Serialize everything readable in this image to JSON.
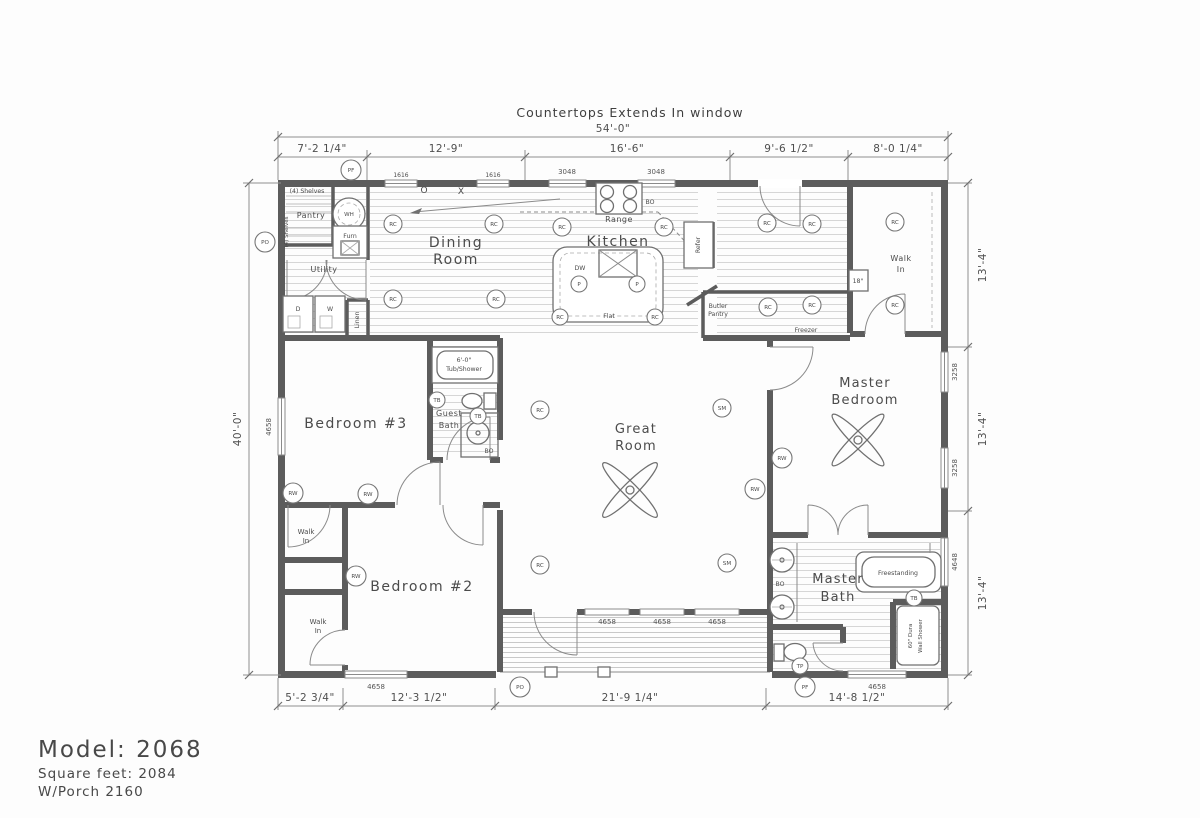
{
  "title": "Countertops Extends In window",
  "footer": {
    "model": "Model: 2068",
    "sqft": "Square feet: 2084",
    "porch": "W/Porch 2160"
  },
  "dims": {
    "overall_w": "54'-0\"",
    "overall_h": "40'-0\"",
    "top": [
      "7'-2 1/4\"",
      "12'-9\"",
      "16'-6\"",
      "9'-6 1/2\"",
      "8'-0 1/4\""
    ],
    "bottom": [
      "5'-2 3/4\"",
      "12'-3 1/2\"",
      "21'-9 1/4\"",
      "14'-8 1/2\""
    ],
    "right": [
      "13'-4\"",
      "13'-4\"",
      "13'-4\""
    ]
  },
  "rooms": {
    "dining": [
      "Dining",
      "Room"
    ],
    "kitchen": "Kitchen",
    "great": [
      "Great",
      "Room"
    ],
    "bedroom2": "Bedroom #2",
    "bedroom3": "Bedroom #3",
    "master_bedroom": [
      "Master",
      "Bedroom"
    ],
    "master_bath": [
      "Master",
      "Bath"
    ],
    "guest_bath": [
      "Guest",
      "Bath"
    ],
    "utility": "Utility",
    "pantry": "Pantry",
    "butler_pantry": [
      "Butler",
      "Pantry"
    ],
    "walk_in": [
      "Walk",
      "In"
    ],
    "freezer": "Freezer"
  },
  "fixtures": {
    "range": "Range",
    "refer": "Refer",
    "dw": "DW",
    "flat": "Flat",
    "furn": "Furn",
    "wh": "WH",
    "dryer": "D",
    "washer": "W",
    "linen": "Linen",
    "shelves": "(4) Shelves",
    "shelf_18": "18\"",
    "tub_shower": [
      "6'-0\"",
      "Tub/Shower"
    ],
    "freestanding": "Freestanding",
    "wall_shower": [
      "60\" Dura",
      "Wall Shower"
    ],
    "open_o": "O",
    "open_x": "X"
  },
  "windows": {
    "w1616": "1616",
    "w3048": "3048",
    "w4658": "4658",
    "w3258": "3258",
    "w4648": "4648"
  },
  "symbols": {
    "rc": "RC",
    "rw": "RW",
    "sm": "SM",
    "pf": "PF",
    "po": "PO",
    "tb": "TB",
    "tp": "TP",
    "p": "P",
    "bo": "BO"
  }
}
